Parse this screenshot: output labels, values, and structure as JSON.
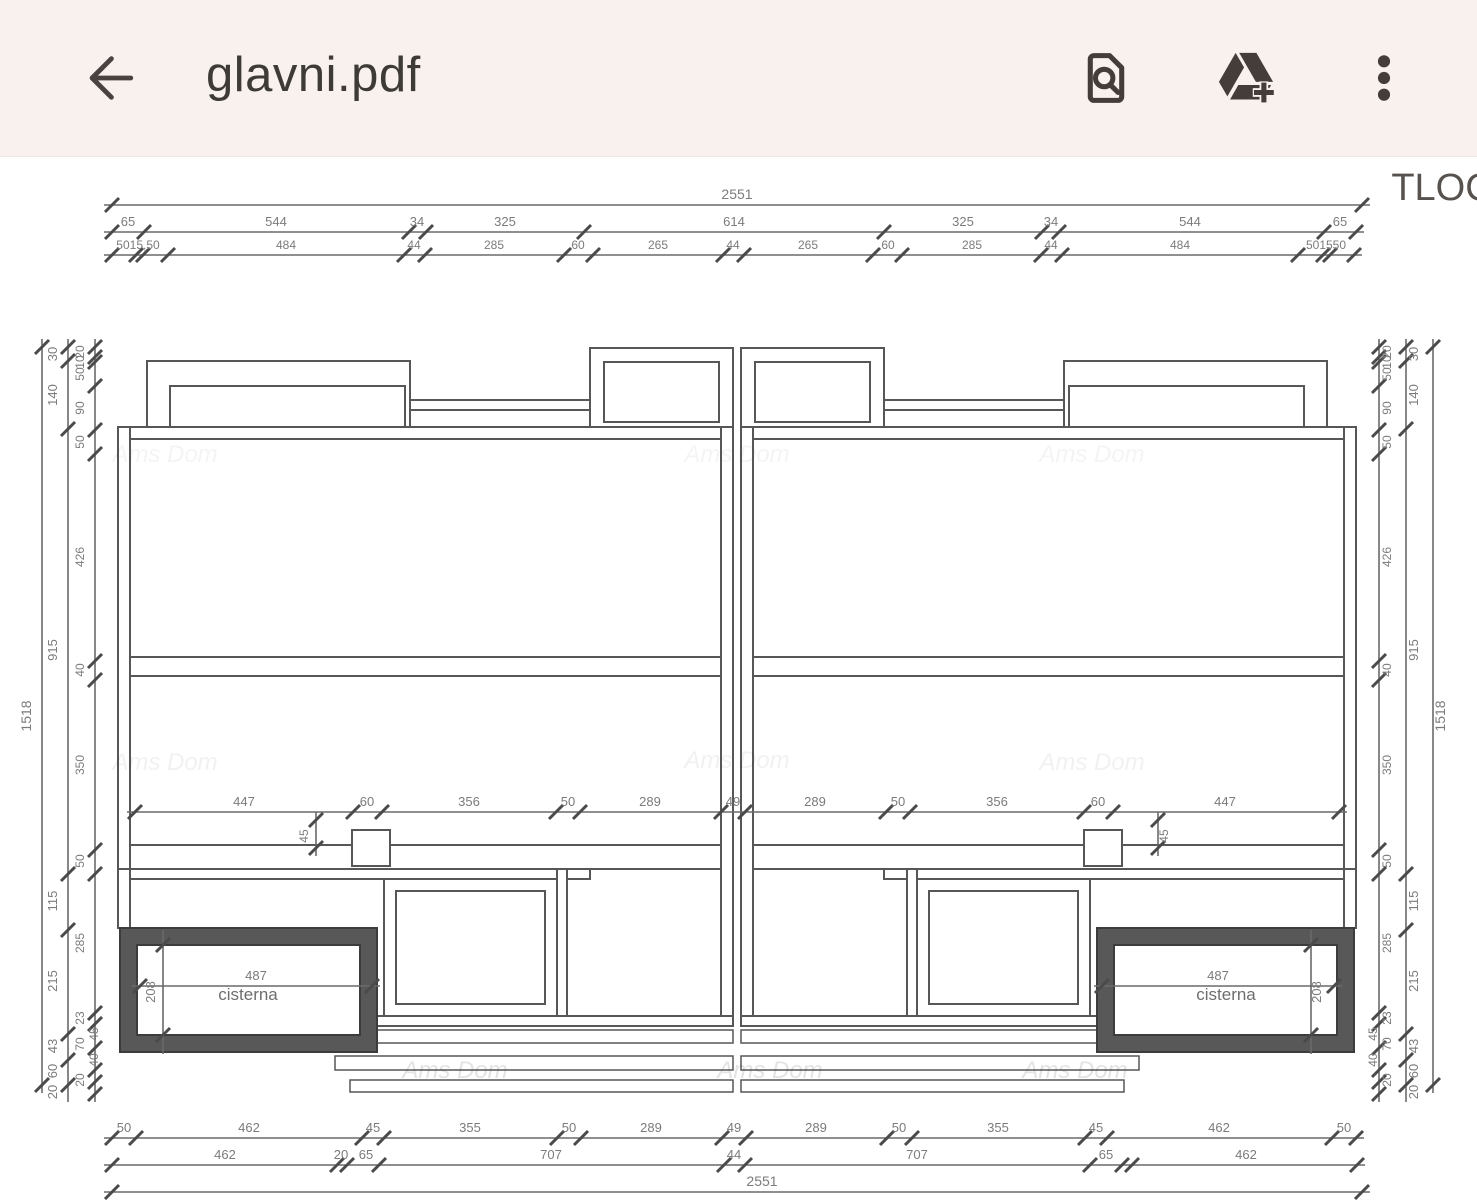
{
  "header": {
    "title": "glavni.pdf",
    "icons": {
      "back": "back-arrow-icon",
      "search_in_document": "find-in-document-icon",
      "add_to_drive": "drive-add-icon",
      "more": "overflow-menu-icon"
    }
  },
  "drawing": {
    "sheet_label": "TLOC",
    "watermark": "Ams Dom",
    "cisterna_left": "cisterna",
    "cisterna_right": "cisterna",
    "watermarks": [
      {
        "x": 165,
        "y": 462,
        "o": 0.06
      },
      {
        "x": 737,
        "y": 462,
        "o": 0.06
      },
      {
        "x": 1092,
        "y": 462,
        "o": 0.06
      },
      {
        "x": 165,
        "y": 770,
        "o": 0.07
      },
      {
        "x": 737,
        "y": 768,
        "o": 0.07
      },
      {
        "x": 1092,
        "y": 770,
        "o": 0.07
      },
      {
        "x": 455,
        "y": 1078,
        "o": 0.14
      },
      {
        "x": 770,
        "y": 1078,
        "o": 0.14
      },
      {
        "x": 1075,
        "y": 1078,
        "o": 0.14
      }
    ],
    "annotations": [
      {
        "t": "TLOC",
        "x": 1442,
        "y": 200,
        "s": 38,
        "c": "#57524e"
      },
      {
        "t": "cisterna",
        "x": 248,
        "y": 1000,
        "s": 17,
        "c": "#6e6e6e"
      },
      {
        "t": "cisterna",
        "x": 1226,
        "y": 1000,
        "s": 17,
        "c": "#6e6e6e"
      },
      {
        "t": "208",
        "x": 155,
        "y": 992,
        "s": 13,
        "c": "#7b7b7b",
        "r": -90
      },
      {
        "t": "208",
        "x": 1321,
        "y": 992,
        "s": 13,
        "c": "#7b7b7b",
        "r": -90
      },
      {
        "t": "45",
        "x": 308,
        "y": 836,
        "s": 12,
        "c": "#7b7b7b",
        "r": -90
      },
      {
        "t": "45",
        "x": 1168,
        "y": 836,
        "s": 12,
        "c": "#7b7b7b",
        "r": -90
      }
    ],
    "h_chains": [
      {
        "y": 205,
        "x1": 112,
        "x2": 1362,
        "fs": 14,
        "ticks": [
          112,
          1362
        ],
        "labels": [
          {
            "t": "2551",
            "x": 737
          }
        ]
      },
      {
        "y": 232,
        "x1": 112,
        "x2": 1356,
        "fs": 13,
        "ticks": [
          112,
          144,
          409,
          426,
          584,
          884,
          1042,
          1059,
          1324,
          1356
        ],
        "labels": [
          {
            "t": "65",
            "x": 128
          },
          {
            "t": "544",
            "x": 276
          },
          {
            "t": "34",
            "x": 417
          },
          {
            "t": "325",
            "x": 505
          },
          {
            "t": "614",
            "x": 734
          },
          {
            "t": "325",
            "x": 963
          },
          {
            "t": "34",
            "x": 1051
          },
          {
            "t": "544",
            "x": 1190
          },
          {
            "t": "65",
            "x": 1340
          }
        ]
      },
      {
        "y": 255,
        "x1": 112,
        "x2": 1354,
        "fs": 12,
        "ticks": [
          112,
          136,
          143,
          168,
          404,
          425,
          564,
          593,
          723,
          744,
          873,
          902,
          1041,
          1062,
          1298,
          1323,
          1330,
          1354
        ],
        "labels": [
          {
            "t": "5015,50",
            "x": 138
          },
          {
            "t": "484",
            "x": 286
          },
          {
            "t": "44",
            "x": 414
          },
          {
            "t": "285",
            "x": 494
          },
          {
            "t": "60",
            "x": 578
          },
          {
            "t": "265",
            "x": 658
          },
          {
            "t": "44",
            "x": 733
          },
          {
            "t": "265",
            "x": 808
          },
          {
            "t": "60",
            "x": 888
          },
          {
            "t": "285",
            "x": 972
          },
          {
            "t": "44",
            "x": 1051
          },
          {
            "t": "484",
            "x": 1180
          },
          {
            "t": "501550",
            "x": 1326
          }
        ]
      },
      {
        "y": 812,
        "x1": 135,
        "x2": 1339,
        "fs": 13,
        "ticks": [
          135,
          353,
          382,
          556,
          580,
          721,
          745,
          886,
          910,
          1084,
          1113,
          1339
        ],
        "labels": [
          {
            "t": "447",
            "x": 244
          },
          {
            "t": "60",
            "x": 367
          },
          {
            "t": "356",
            "x": 469
          },
          {
            "t": "50",
            "x": 568
          },
          {
            "t": "289",
            "x": 650
          },
          {
            "t": "49",
            "x": 733
          },
          {
            "t": "289",
            "x": 815
          },
          {
            "t": "50",
            "x": 898
          },
          {
            "t": "356",
            "x": 997
          },
          {
            "t": "60",
            "x": 1098
          },
          {
            "t": "447",
            "x": 1225
          }
        ]
      },
      {
        "y": 986,
        "x1": 140,
        "x2": 372,
        "fs": 13,
        "ticks": [
          140,
          372
        ],
        "labels": [
          {
            "t": "487",
            "x": 256
          }
        ]
      },
      {
        "y": 986,
        "x1": 1102,
        "x2": 1334,
        "fs": 13,
        "ticks": [
          1102,
          1334
        ],
        "labels": [
          {
            "t": "487",
            "x": 1218
          }
        ]
      },
      {
        "y": 1138,
        "x1": 112,
        "x2": 1356,
        "fs": 13,
        "ticks": [
          112,
          136,
          362,
          384,
          557,
          581,
          722,
          746,
          887,
          912,
          1085,
          1107,
          1332,
          1356
        ],
        "labels": [
          {
            "t": "50",
            "x": 124
          },
          {
            "t": "462",
            "x": 249
          },
          {
            "t": "45",
            "x": 373
          },
          {
            "t": "355",
            "x": 470
          },
          {
            "t": "50",
            "x": 569
          },
          {
            "t": "289",
            "x": 651
          },
          {
            "t": "49",
            "x": 734
          },
          {
            "t": "289",
            "x": 816
          },
          {
            "t": "50",
            "x": 899
          },
          {
            "t": "355",
            "x": 998
          },
          {
            "t": "45",
            "x": 1096
          },
          {
            "t": "462",
            "x": 1219
          },
          {
            "t": "50",
            "x": 1344
          }
        ]
      },
      {
        "y": 1165,
        "x1": 112,
        "x2": 1357,
        "fs": 13,
        "ticks": [
          112,
          337,
          347,
          379,
          724,
          745,
          1090,
          1122,
          1132,
          1357
        ],
        "labels": [
          {
            "t": "462",
            "x": 225
          },
          {
            "t": "20",
            "x": 341
          },
          {
            "t": "65",
            "x": 366
          },
          {
            "t": "707",
            "x": 551
          },
          {
            "t": "44",
            "x": 734
          },
          {
            "t": "707",
            "x": 917
          },
          {
            "t": "65",
            "x": 1106
          },
          {
            "t": "462",
            "x": 1246
          }
        ]
      },
      {
        "y": 1192,
        "x1": 112,
        "x2": 1362,
        "fs": 14,
        "ticks": [
          112,
          1362
        ],
        "labels": [
          {
            "t": "2551",
            "x": 762
          }
        ]
      }
    ],
    "v_chains": [
      {
        "x": 42,
        "y1": 347,
        "y2": 1085,
        "lx": -11,
        "fs": 14,
        "ticks": [
          347,
          1085
        ],
        "labels": [
          {
            "t": "1518",
            "y": 716
          }
        ]
      },
      {
        "x": 68,
        "y1": 347,
        "y2": 1094,
        "lx": -11,
        "fs": 13,
        "ticks": [
          347,
          361,
          429,
          874,
          930,
          1034,
          1060,
          1085
        ],
        "labels": [
          {
            "t": "30",
            "y": 354
          },
          {
            "t": "140",
            "y": 395
          },
          {
            "t": "915",
            "y": 650
          },
          {
            "t": "115",
            "y": 901
          },
          {
            "t": "215",
            "y": 981
          },
          {
            "t": "43",
            "y": 1046
          },
          {
            "t": "60",
            "y": 1071
          },
          {
            "t": "20",
            "y": 1092
          }
        ]
      },
      {
        "x": 95,
        "y1": 347,
        "y2": 1094,
        "lx": -11,
        "fs": 12,
        "ticks": [
          347,
          357,
          362,
          386,
          430,
          454,
          661,
          680,
          850,
          874,
          1013,
          1024,
          1048,
          1070,
          1082,
          1094
        ],
        "labels": [
          {
            "t": "20",
            "y": 352
          },
          {
            "t": "10",
            "y": 362
          },
          {
            "t": "50",
            "y": 374
          },
          {
            "t": "90",
            "y": 408
          },
          {
            "t": "50",
            "y": 442
          },
          {
            "t": "426",
            "y": 557
          },
          {
            "t": "40",
            "y": 670
          },
          {
            "t": "350",
            "y": 765
          },
          {
            "t": "50",
            "y": 861
          },
          {
            "t": "285",
            "y": 943
          },
          {
            "t": "23",
            "y": 1018
          },
          {
            "t": "45",
            "y": 1034,
            "dx": 14
          },
          {
            "t": "70",
            "y": 1044
          },
          {
            "t": "40",
            "y": 1060,
            "dx": 14
          },
          {
            "t": "20",
            "y": 1080
          }
        ]
      },
      {
        "x": 1379,
        "y1": 347,
        "y2": 1094,
        "lx": 12,
        "fs": 12,
        "ticks": [
          347,
          357,
          362,
          386,
          430,
          454,
          661,
          680,
          850,
          874,
          1013,
          1024,
          1048,
          1070,
          1082,
          1094
        ],
        "labels": [
          {
            "t": "20",
            "y": 352
          },
          {
            "t": "10",
            "y": 362
          },
          {
            "t": "50",
            "y": 374
          },
          {
            "t": "90",
            "y": 408
          },
          {
            "t": "50",
            "y": 442
          },
          {
            "t": "426",
            "y": 557
          },
          {
            "t": "40",
            "y": 670
          },
          {
            "t": "350",
            "y": 765
          },
          {
            "t": "50",
            "y": 861
          },
          {
            "t": "285",
            "y": 943
          },
          {
            "t": "23",
            "y": 1018
          },
          {
            "t": "45",
            "y": 1034,
            "dx": -14
          },
          {
            "t": "70",
            "y": 1044
          },
          {
            "t": "40",
            "y": 1060,
            "dx": -14
          },
          {
            "t": "20",
            "y": 1080
          }
        ]
      },
      {
        "x": 1406,
        "y1": 347,
        "y2": 1094,
        "lx": 12,
        "fs": 13,
        "ticks": [
          347,
          361,
          429,
          874,
          930,
          1034,
          1060,
          1085
        ],
        "labels": [
          {
            "t": "30",
            "y": 354
          },
          {
            "t": "140",
            "y": 395
          },
          {
            "t": "915",
            "y": 650
          },
          {
            "t": "115",
            "y": 901
          },
          {
            "t": "215",
            "y": 981
          },
          {
            "t": "43",
            "y": 1046
          },
          {
            "t": "60",
            "y": 1071
          },
          {
            "t": "20",
            "y": 1092
          }
        ]
      },
      {
        "x": 1433,
        "y1": 347,
        "y2": 1085,
        "lx": 12,
        "fs": 14,
        "ticks": [
          347,
          1085
        ],
        "labels": [
          {
            "t": "1518",
            "y": 716
          }
        ]
      },
      {
        "x": 163,
        "y1": 938,
        "y2": 1046,
        "lx": -9,
        "fs": 12,
        "ticks": [
          945,
          1035
        ],
        "labels": []
      },
      {
        "x": 1311,
        "y1": 938,
        "y2": 1046,
        "lx": 9,
        "fs": 12,
        "ticks": [
          945,
          1035
        ],
        "labels": []
      },
      {
        "x": 316,
        "y1": 820,
        "y2": 848,
        "lx": -8,
        "fs": 12,
        "ticks": [
          820,
          848
        ],
        "labels": []
      },
      {
        "x": 1158,
        "y1": 820,
        "y2": 848,
        "lx": 8,
        "fs": 12,
        "ticks": [
          820,
          848
        ],
        "labels": []
      }
    ]
  }
}
